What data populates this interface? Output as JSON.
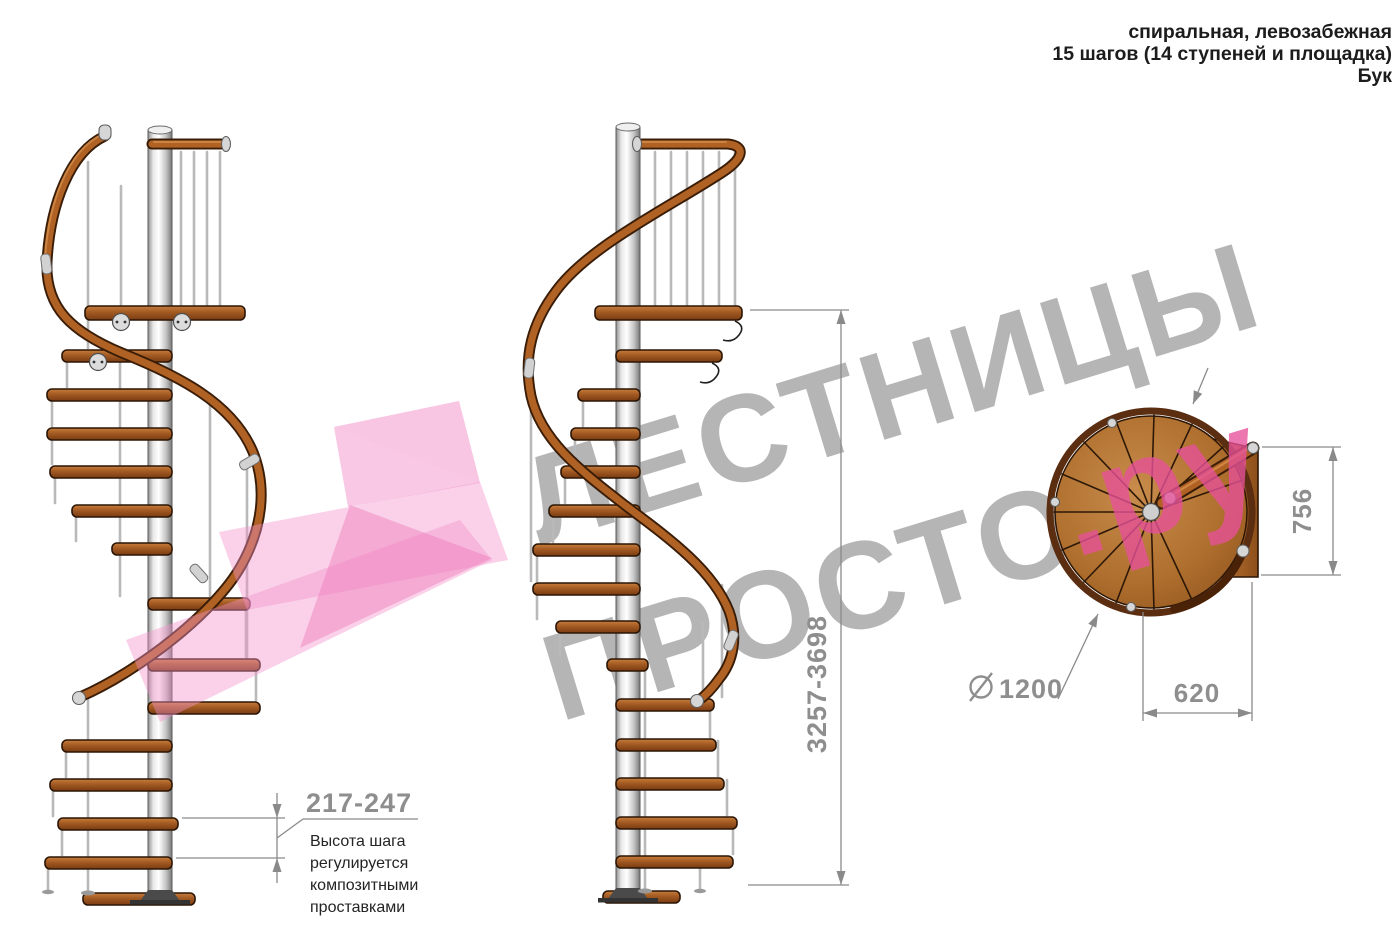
{
  "header": {
    "lines": [
      "спиральная, левозабежная",
      "15 шагов (14 ступеней и площадка)",
      "Бук"
    ]
  },
  "watermark": {
    "line1": "ЛЕСТНИЦЫ",
    "line2_gray": "ПРОСТО",
    "line2_pink": ".ру",
    "text_color": "#909090",
    "pink_text_color": "#e7519a",
    "logo_pink_color": "#f2a0d0"
  },
  "dimensions": {
    "total_height": {
      "label": "3257-3698"
    },
    "plan_depth": {
      "label": "756"
    },
    "plan_width": {
      "label": "620"
    },
    "diameter": {
      "symbol": "⌀",
      "label": "1200"
    },
    "step_height": {
      "label": "217-247",
      "note_lines": [
        "Высота шага",
        "регулируется",
        "композитными",
        "проставками"
      ]
    }
  },
  "colors": {
    "background": "#ffffff",
    "wood_rail": "#b06124",
    "wood_tread": "#9c5120",
    "wood_dark_outline": "#2b1605",
    "metal_pole": "#d9d9d9",
    "dimension_gray": "#8e8e8e",
    "note_text": "#242424"
  }
}
